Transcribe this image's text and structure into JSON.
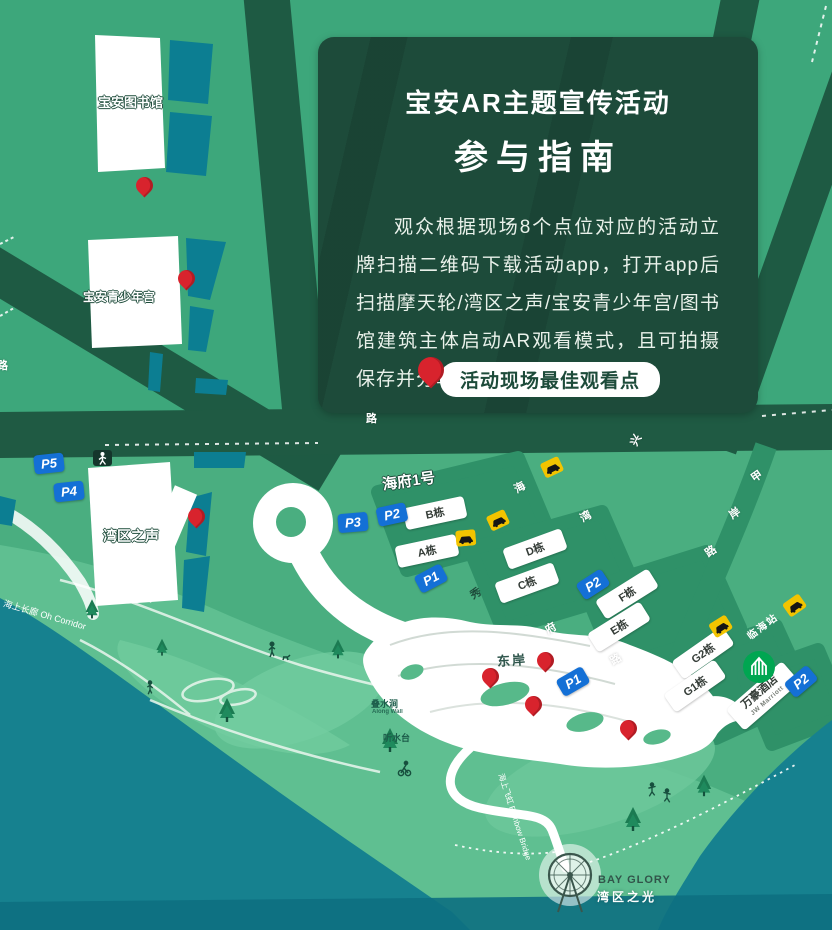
{
  "panel": {
    "title_line1": "宝安AR主题宣传活动",
    "title_line2": "参与指南",
    "body": "观众根据现场8个点位对应的活动立牌扫描二维码下载活动app，打开app后扫描摩天轮/湾区之声/宝安青少年宫/图书馆建筑主体启动AR观看模式，且可拍摄保存并分享。",
    "badge": "活动现场最佳观看点"
  },
  "landmarks": {
    "library": "宝安图书馆",
    "youth_palace": "宝安青少年宫",
    "bay_voice": "湾区之声",
    "haifu": "海府1号",
    "east_bank": "东岸",
    "marriott_cn": "万豪酒店",
    "marriott_en": "JW Marriott",
    "metro_station": "临海站",
    "corridor": "海上长廊 Oh Corridor",
    "rainbow_bridge": "海上飞虹 Rainbow Bridge",
    "water_feature_1": "叠水涧",
    "water_feature_1_en": "Along Wall",
    "water_feature_2": "听水台",
    "bay_glory_en": "BAY GLORY",
    "bay_glory_cn": "湾区之光"
  },
  "buildings": [
    "B栋",
    "A栋",
    "D栋",
    "C栋",
    "F栋",
    "E栋",
    "G2栋",
    "G1栋"
  ],
  "parking": {
    "p5": "P5",
    "p4": "P4",
    "p3": "P3",
    "p2a": "P2",
    "p1a": "P1",
    "p2b": "P2",
    "p1b": "P1",
    "p2c": "P2"
  },
  "roads": {
    "jiaan": [
      "甲",
      "岸",
      "路"
    ],
    "haiwan": [
      "海",
      "湾"
    ],
    "xiufu": [
      "秀",
      "府",
      "路"
    ],
    "band": [
      "路"
    ],
    "left": [
      "路"
    ],
    "xinghua": [
      "兴"
    ]
  },
  "colors": {
    "panel_green": "#1d4b3a",
    "pin_red": "#d8232d",
    "parking_blue": "#1470d6",
    "taxi_yellow": "#f2c400",
    "metro_green": "#00a651",
    "water_teal": "#16818f",
    "building_teal": "#0c7e92"
  }
}
